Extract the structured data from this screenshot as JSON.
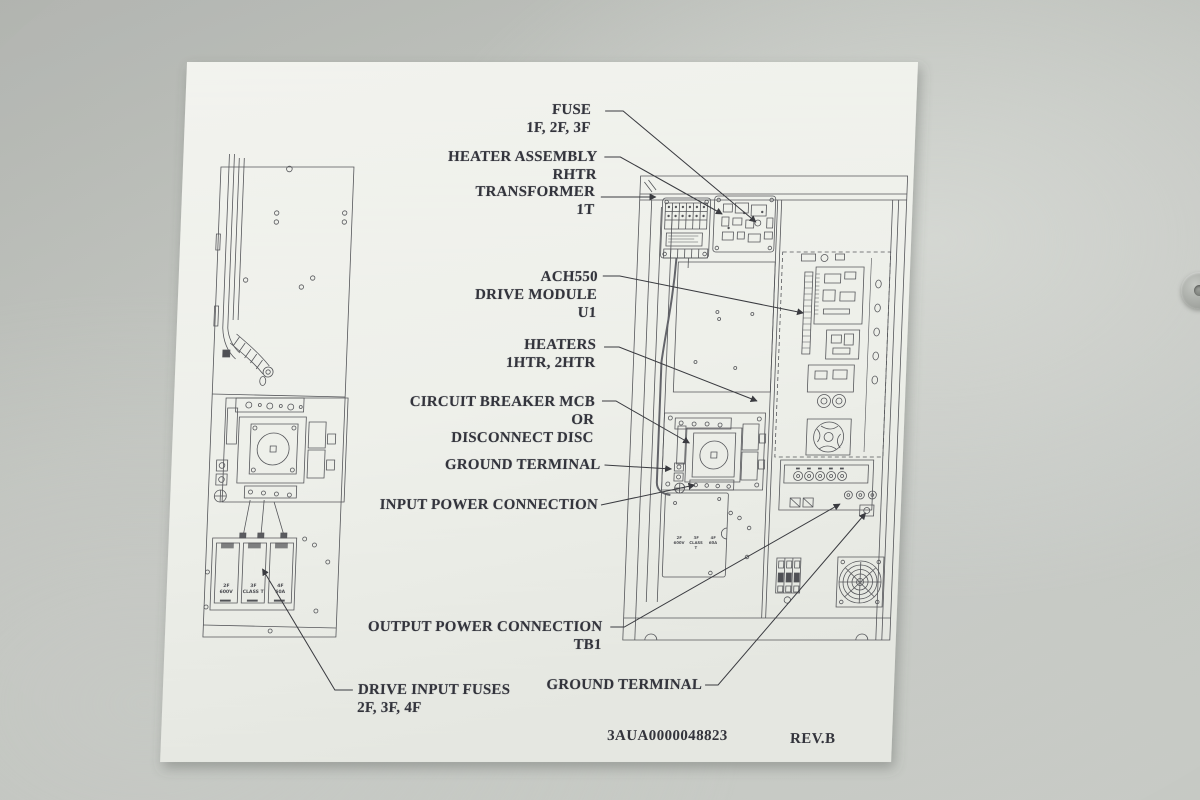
{
  "photo": {
    "background_color": "#c4c7c2",
    "paper_color": "#f0f1ec",
    "ink_color": "#4f5054",
    "text_color": "#33343c"
  },
  "document": {
    "part_number": "3AUA0000048823",
    "revision": "REV.B",
    "callouts": [
      {
        "id": "fuse",
        "text": "FUSE\n1F, 2F, 3F"
      },
      {
        "id": "heater-assembly",
        "text": "HEATER ASSEMBLY\nRHTR"
      },
      {
        "id": "transformer",
        "text": "TRANSFORMER\n1T"
      },
      {
        "id": "drive-module",
        "text": "ACH550\nDRIVE MODULE\nU1"
      },
      {
        "id": "heaters",
        "text": "HEATERS\n1HTR, 2HTR"
      },
      {
        "id": "circuit-breaker",
        "text": "CIRCUIT BREAKER MCB\nOR\nDISCONNECT DISC"
      },
      {
        "id": "ground-terminal-upper",
        "text": "GROUND TERMINAL"
      },
      {
        "id": "input-power",
        "text": "INPUT POWER CONNECTION"
      },
      {
        "id": "output-power",
        "text": "OUTPUT POWER CONNECTION\nTB1"
      },
      {
        "id": "ground-terminal-lower",
        "text": "GROUND TERMINAL"
      },
      {
        "id": "drive-input-fuses",
        "text": "DRIVE INPUT FUSES\n2F, 3F, 4F"
      }
    ],
    "left_fuse_labels": [
      "2F\n600V",
      "3F\nCLASS T",
      "4F\n60A"
    ],
    "right_fuse_labels": [
      "2F\n600V",
      "3F\nCLASS T",
      "4F\n60A"
    ]
  }
}
